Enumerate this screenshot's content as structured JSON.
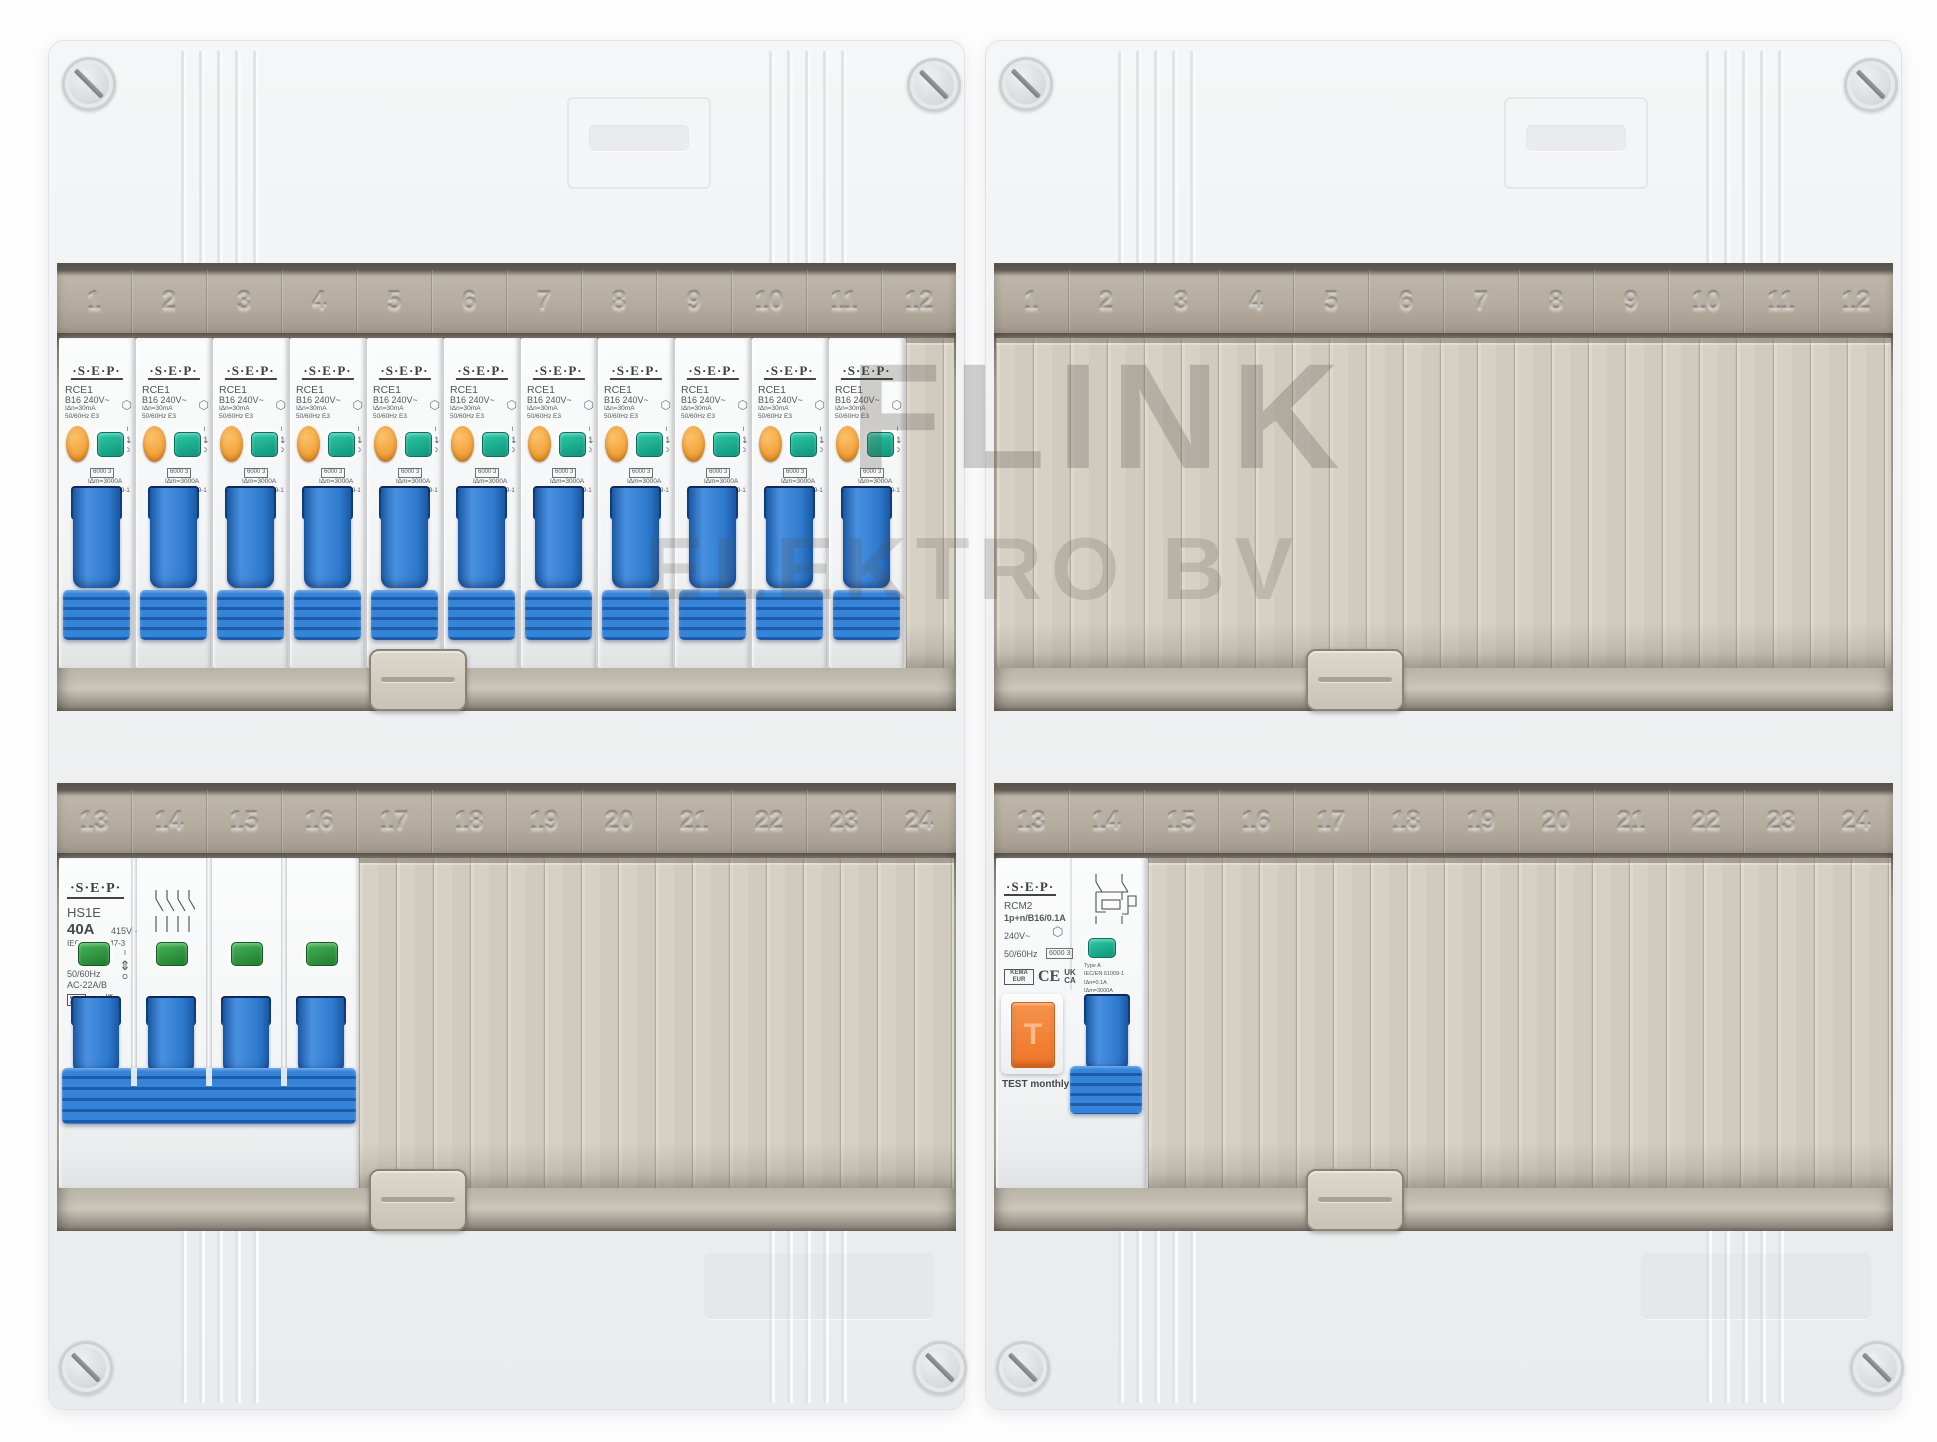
{
  "watermark": {
    "line1": "FLINK",
    "line2": "ELEKTRO BV"
  },
  "strip_numbers": {
    "top": [
      "1",
      "2",
      "3",
      "4",
      "5",
      "6",
      "7",
      "8",
      "9",
      "10",
      "11",
      "12"
    ],
    "bottom": [
      "13",
      "14",
      "15",
      "16",
      "17",
      "18",
      "19",
      "20",
      "21",
      "22",
      "23",
      "24"
    ]
  },
  "devices": {
    "rce1": {
      "brand": "·S·E·P·",
      "model": "RCE1",
      "rating": "B16  240V~",
      "sensitivity": "IΔn=30mA",
      "freq_class": "50/60Hz   E3",
      "breaking_box": "6000 3",
      "im_rating": "IΔm=3000A",
      "standard": "IEC/EN 61009-1",
      "kema": "KEMA KEUR",
      "ce": "CE",
      "ukca": "UK CA",
      "on_label": "I",
      "off_label": "O",
      "updown_icon": "⇅",
      "cert_icon": "⬡",
      "count": 11
    },
    "hs1e": {
      "brand": "·S·E·P·",
      "model": "HS1E",
      "rating": "40A",
      "voltage": "415V~",
      "standard": "IEC/EN 60947-3",
      "freq": "50/60Hz",
      "utilization": "AC-22A/B",
      "kema": "KEMA KEUR",
      "ce": "CE",
      "ukca": "UK CA",
      "on_label": "I",
      "off_label": "O",
      "updown_icon": "⇕",
      "poles": 4
    },
    "rcm2": {
      "brand": "·S·E·P·",
      "model": "RCM2",
      "spec": "1p+n/B16/0.1A",
      "voltage": "240V~",
      "freq": "50/60Hz",
      "breaking_box": "6000 3",
      "type_label": "Type A",
      "standard": "IEC/EN 61009-1",
      "idn": "IΔn=0.1A",
      "idm": "IΔm=3000A",
      "kema": "KEMA EUR",
      "ce": "CE",
      "ukca": "UK CA",
      "test_label": "T",
      "test_note": "TEST monthly",
      "cert_icon": "⬡"
    }
  },
  "layout": {
    "windows": [
      {
        "enclosure": 0,
        "row": "top",
        "devices": [
          {
            "tpl": "rce1",
            "count": 11
          }
        ]
      },
      {
        "enclosure": 0,
        "row": "bottom",
        "devices": [
          {
            "tpl": "hs1e",
            "count": 1
          }
        ]
      },
      {
        "enclosure": 1,
        "row": "top",
        "devices": []
      },
      {
        "enclosure": 1,
        "row": "bottom",
        "devices": [
          {
            "tpl": "rcm2",
            "count": 1
          }
        ]
      }
    ]
  },
  "colors": {
    "toggle_blue": "#2e7cd4",
    "test_orange": "#f2a33c",
    "rcm_test_orange": "#ee7527",
    "indicator_teal": "#18b496",
    "indicator_green": "#2f9e44",
    "blank_plate_beige": "#d6d0c4",
    "enclosure_white": "#eef0f2"
  }
}
